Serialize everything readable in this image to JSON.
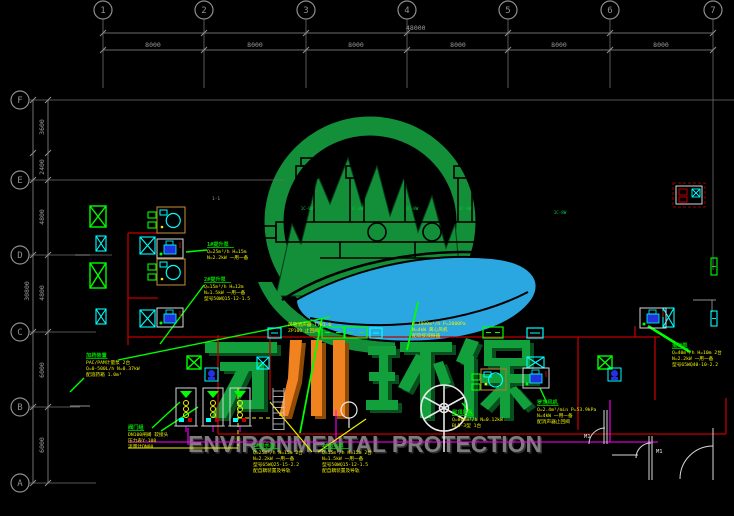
{
  "canvas": {
    "w": 734,
    "h": 516
  },
  "palette": {
    "grid": "#8f8f8f",
    "gridline": "#6f6f6f",
    "dim_text": "#9a9a9a",
    "red": "#c00000",
    "green": "#00dc00",
    "bright_green": "#00ff00",
    "cyan": "#00ffff",
    "yellow": "#f0f000",
    "magenta": "#ff00ff",
    "blue": "#2233dd",
    "tan": "#a8792f",
    "white": "#e8e8e8",
    "logo_green": "#128f38",
    "logo_blue": "#2aa7e0",
    "wm_green": "#12a03c",
    "wm_green_dark": "#07501d",
    "wm_orange": "#f08220",
    "wm_orange_dark": "#8f4b05",
    "env_gray": "#7e7e7e"
  },
  "watermark": {
    "en": "ENVIRONMENTAL PROTECTION",
    "cn": "万川环保"
  },
  "grid": {
    "top": {
      "y": 10,
      "dim1_y": 33,
      "dim2_y": 50,
      "overall": {
        "label": "48000",
        "x": 406,
        "y": 30
      },
      "bubbles": [
        {
          "label": "1",
          "x": 103
        },
        {
          "label": "2",
          "x": 204
        },
        {
          "label": "3",
          "x": 306
        },
        {
          "label": "4",
          "x": 407
        },
        {
          "label": "5",
          "x": 508
        },
        {
          "label": "6",
          "x": 610
        },
        {
          "label": "7",
          "x": 713
        }
      ],
      "bays": [
        {
          "label": "8000",
          "x": 153
        },
        {
          "label": "8000",
          "x": 255
        },
        {
          "label": "8000",
          "x": 356
        },
        {
          "label": "8000",
          "x": 458
        },
        {
          "label": "8000",
          "x": 559
        },
        {
          "label": "8000",
          "x": 661
        }
      ]
    },
    "left": {
      "x": 20,
      "dim1_x": 33,
      "dim2_x": 48,
      "overall": {
        "label": "30800",
        "x": 29,
        "y": 291
      },
      "bubbles": [
        {
          "label": "F",
          "y": 100,
          "line_x2": 734
        },
        {
          "label": "E",
          "y": 180,
          "line_x2": 285
        },
        {
          "label": "D",
          "y": 255,
          "line_x2": 112
        },
        {
          "label": "C",
          "y": 332,
          "line_x2": 96
        },
        {
          "label": "B",
          "y": 407,
          "line_x2": 80
        },
        {
          "label": "A",
          "y": 483,
          "line_x2": 96
        }
      ],
      "ticks_y": [
        100,
        153,
        180,
        255,
        332,
        407,
        483
      ],
      "segs": [
        {
          "label": "3600",
          "y": 127
        },
        {
          "label": "2400",
          "y": 167
        },
        {
          "label": "4800",
          "y": 217
        },
        {
          "label": "4800",
          "y": 293
        },
        {
          "label": "6000",
          "y": 370
        },
        {
          "label": "6000",
          "y": 445
        }
      ]
    }
  },
  "annotations": [
    {
      "x": 86,
      "y": 357,
      "title": "加药装置",
      "lines": [
        "PAC/PAM计量泵 2台",
        "Q=0-500L/h N=0.37kW",
        "配溶药箱 1.0m³"
      ]
    },
    {
      "x": 207,
      "y": 246,
      "title": "1#提升泵",
      "lines": [
        "Q=25m³/h H=15m",
        "N=2.2kW 一用一备"
      ]
    },
    {
      "x": 204,
      "y": 281,
      "title": "2#提升泵",
      "lines": [
        "Q=15m³/h H=12m",
        "N=1.5kW 一用一备",
        "型号50WQ15-12-1.5"
      ]
    },
    {
      "x": 288,
      "y": 319,
      "title": "",
      "lines": [
        "风管消声器 T701-6",
        "ZP100 止回阀"
      ]
    },
    {
      "x": 412,
      "y": 318,
      "title": "",
      "lines": [
        "Q=3000m³/h P=2000Pa",
        "N=4kW 离心风机",
        "配软接减振器"
      ]
    },
    {
      "x": 253,
      "y": 447,
      "title": "1#污水泵",
      "lines": [
        "Q=25m³/h H=15m 2台",
        "N=2.2kW 一用一备",
        "型号65WQ25-15-2.2",
        "配自耦装置及导轨"
      ]
    },
    {
      "x": 322,
      "y": 447,
      "title": "2#污水泵",
      "lines": [
        "Q=15m³/h H=12m 2台",
        "N=1.5kW 一用一备",
        "型号50WQ15-12-1.5",
        "配自耦装置及导轨"
      ]
    },
    {
      "x": 452,
      "y": 414,
      "title": "屋顶风机",
      "lines": [
        "Q=800m³/h N=0.12kW",
        "BLD-3型 1台"
      ]
    },
    {
      "x": 537,
      "y": 404,
      "title": "罗茨风机",
      "lines": [
        "Q=2.4m³/min P=53.9kPa",
        "N=4kW 一用一备",
        "配消声器止回阀"
      ]
    },
    {
      "x": 672,
      "y": 347,
      "title": "潜污泵",
      "lines": [
        "Q=40m³/h H=10m 2台",
        "N=2.2kW 一用一备",
        "型号65WQ40-10-2.2"
      ]
    },
    {
      "x": 128,
      "y": 429,
      "title": "阀门组",
      "lines": [
        "DN100闸阀 软接头",
        "压力表Y-100",
        "流量计DN80"
      ]
    }
  ],
  "duct_labels": [
    {
      "text": "1C-8W",
      "x": 307,
      "y": 210
    },
    {
      "text": "1C-8W",
      "x": 357,
      "y": 210
    },
    {
      "text": "1C-8W",
      "x": 412,
      "y": 210
    },
    {
      "text": "1C-8W",
      "x": 465,
      "y": 210
    },
    {
      "text": "1C-8W",
      "x": 560,
      "y": 214
    }
  ],
  "door_labels": [
    {
      "text": "M1",
      "x": 584,
      "y": 438
    },
    {
      "text": "M1",
      "x": 656,
      "y": 453
    }
  ],
  "misc_labels": [
    {
      "text": "1-1",
      "x": 212,
      "y": 200
    }
  ],
  "leaders": [
    {
      "x1": 118,
      "y1": 360,
      "x2": 330,
      "y2": 317,
      "c": "g",
      "w": 1.4
    },
    {
      "x1": 204,
      "y1": 285,
      "x2": 160,
      "y2": 344,
      "c": "g",
      "w": 1.4
    },
    {
      "x1": 207,
      "y1": 250,
      "x2": 186,
      "y2": 252,
      "c": "g",
      "w": 1.4
    },
    {
      "x1": 300,
      "y1": 433,
      "x2": 322,
      "y2": 318,
      "c": "g",
      "w": 1.8
    },
    {
      "x1": 407,
      "y1": 350,
      "x2": 418,
      "y2": 302,
      "c": "g",
      "w": 1.8
    },
    {
      "x1": 540,
      "y1": 388,
      "x2": 547,
      "y2": 403,
      "c": "g",
      "w": 1.4
    },
    {
      "x1": 648,
      "y1": 326,
      "x2": 690,
      "y2": 352,
      "c": "g",
      "w": 2.6
    },
    {
      "x1": 462,
      "y1": 403,
      "x2": 472,
      "y2": 414,
      "c": "g",
      "w": 1.4
    },
    {
      "x1": 152,
      "y1": 428,
      "x2": 180,
      "y2": 402,
      "c": "g",
      "w": 1.4
    },
    {
      "x1": 161,
      "y1": 431,
      "x2": 198,
      "y2": 407,
      "c": "g",
      "w": 1.4
    },
    {
      "x1": 70,
      "y1": 392,
      "x2": 84,
      "y2": 378,
      "c": "g",
      "w": 1.4
    },
    {
      "x1": 270,
      "y1": 402,
      "x2": 312,
      "y2": 452,
      "c": "y",
      "w": 1.2
    },
    {
      "x1": 366,
      "y1": 419,
      "x2": 318,
      "y2": 452,
      "c": "y",
      "w": 1.2
    }
  ],
  "red_lines": [
    {
      "x1": 128,
      "y1": 233,
      "x2": 128,
      "y2": 345
    },
    {
      "x1": 128,
      "y1": 233,
      "x2": 158,
      "y2": 233
    },
    {
      "x1": 128,
      "y1": 298,
      "x2": 158,
      "y2": 298
    },
    {
      "x1": 128,
      "y1": 337,
      "x2": 660,
      "y2": 337
    },
    {
      "x1": 218,
      "y1": 335,
      "x2": 218,
      "y2": 434
    },
    {
      "x1": 270,
      "y1": 335,
      "x2": 270,
      "y2": 400
    },
    {
      "x1": 578,
      "y1": 337,
      "x2": 578,
      "y2": 430
    },
    {
      "x1": 655,
      "y1": 337,
      "x2": 655,
      "y2": 400
    },
    {
      "x1": 218,
      "y1": 434,
      "x2": 726,
      "y2": 434
    },
    {
      "x1": 726,
      "y1": 398,
      "x2": 726,
      "y2": 434
    },
    {
      "x1": 635,
      "y1": 326,
      "x2": 635,
      "y2": 337
    }
  ],
  "magenta_lines": [
    {
      "x1": 128,
      "y1": 442,
      "x2": 658,
      "y2": 442
    },
    {
      "x1": 336,
      "y1": 410,
      "x2": 336,
      "y2": 442
    },
    {
      "x1": 610,
      "y1": 400,
      "x2": 610,
      "y2": 442
    },
    {
      "x1": 188,
      "y1": 428,
      "x2": 188,
      "y2": 445
    }
  ],
  "yellow_lines": [
    {
      "x1": 238,
      "y1": 388,
      "x2": 238,
      "y2": 446,
      "dash": 1
    },
    {
      "x1": 238,
      "y1": 418,
      "x2": 272,
      "y2": 418,
      "dash": 1
    },
    {
      "x1": 128,
      "y1": 448,
      "x2": 238,
      "y2": 448,
      "dash": 0
    }
  ],
  "equipment": {
    "green_x": [
      [
        90,
        206,
        16,
        21
      ],
      [
        90,
        263,
        16,
        25
      ],
      [
        187,
        356,
        14,
        13
      ],
      [
        598,
        356,
        14,
        13
      ]
    ],
    "cyan_x": [
      [
        96,
        236,
        10,
        15
      ],
      [
        96,
        309,
        10,
        15
      ],
      [
        140,
        237,
        15,
        17
      ],
      [
        140,
        310,
        15,
        17
      ],
      [
        663,
        308,
        11,
        19
      ],
      [
        257,
        357,
        12,
        12
      ],
      [
        527,
        357,
        17,
        11
      ]
    ],
    "fan_unit": [
      [
        157,
        207,
        28,
        26
      ],
      [
        157,
        259,
        28,
        26
      ],
      [
        481,
        369,
        25,
        21
      ]
    ],
    "pump_unit": [
      [
        157,
        239,
        26,
        19
      ],
      [
        157,
        308,
        26,
        19
      ],
      [
        640,
        308,
        26,
        20
      ],
      [
        523,
        368,
        26,
        20
      ]
    ],
    "small_pump": [
      [
        205,
        368,
        13,
        13
      ],
      [
        608,
        368,
        13,
        13
      ]
    ],
    "louver_green": [
      [
        322,
        327,
        22,
        11
      ],
      [
        345,
        327,
        22,
        11
      ],
      [
        483,
        327,
        20,
        11
      ]
    ],
    "louver_cyan": [
      [
        268,
        328,
        13,
        10
      ],
      [
        370,
        328,
        12,
        10
      ],
      [
        527,
        328,
        16,
        10
      ]
    ],
    "rack": [
      [
        176,
        388,
        20,
        38
      ],
      [
        203,
        388,
        20,
        38
      ],
      [
        230,
        388,
        20,
        38
      ]
    ],
    "vrect": [
      {
        "x": 711,
        "y": 258,
        "w": 6,
        "h": 17,
        "color": "green"
      },
      {
        "x": 711,
        "y": 311,
        "w": 6,
        "h": 15,
        "color": "cyan"
      }
    ],
    "ctrl_box": [
      {
        "x": 676,
        "y": 186,
        "w": 26,
        "h": 18
      }
    ]
  }
}
